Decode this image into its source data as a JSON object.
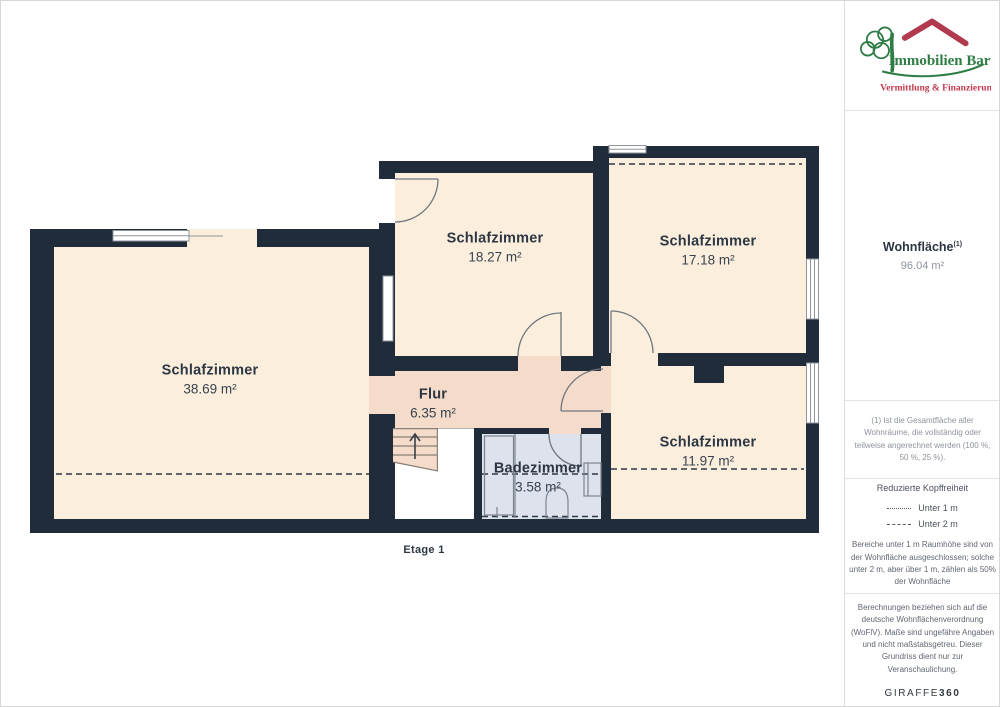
{
  "floorplan": {
    "floor_label": "Etage 1",
    "rooms": [
      {
        "name": "Schlafzimmer",
        "area": "38.69 m²"
      },
      {
        "name": "Schlafzimmer",
        "area": "18.27 m²"
      },
      {
        "name": "Schlafzimmer",
        "area": "17.18 m²"
      },
      {
        "name": "Schlafzimmer",
        "area": "11.97 m²"
      },
      {
        "name": "Flur",
        "area": "6.35 m²"
      },
      {
        "name": "Badezimmer",
        "area": "3.58 m²"
      }
    ]
  },
  "sidebar": {
    "logo": {
      "title": "Immobilien Bart",
      "subtitle": "Vermittlung & Finanzierung"
    },
    "area_summary": {
      "label": "Wohnfläche",
      "footnote_marker": "(1)",
      "value": "96.04 m²"
    },
    "footnote": "(1) Ist die Gesamtfläche aller Wohnräume, die vollständig oder teilweise angerechnet werden (100 %, 50 %, 25 %).",
    "legend": {
      "title": "Reduzierte Kopffreiheit",
      "items": [
        {
          "icon": "dotted-line",
          "label": "Unter 1 m"
        },
        {
          "icon": "dashed-line",
          "label": "Unter 2 m"
        }
      ],
      "note": "Bereiche unter 1 m Raumhöhe sind von der Wohnfläche ausgeschlossen; solche unter 2 m, aber über 1 m, zählen als 50% der Wohnfläche"
    },
    "disclaimer": "Berechnungen beziehen sich auf die deutsche Wohnflächenverordnung (WoFlV). Maße sind ungefähre Angaben und nicht maßstabsgetreu. Dieser Grundriss dient nur zur Veranschaulichung.",
    "brand": {
      "name": "GIRAFFE",
      "suffix": "360"
    }
  },
  "colors": {
    "wall": "#212c3a",
    "room_fill": "#fbeedd",
    "hallway_fill": "#f5dbc9",
    "bathroom_fill": "#dee2ed",
    "dashed_line": "#2d3845",
    "brand_green": "#2e7d46",
    "brand_red": "#b23a4e"
  }
}
